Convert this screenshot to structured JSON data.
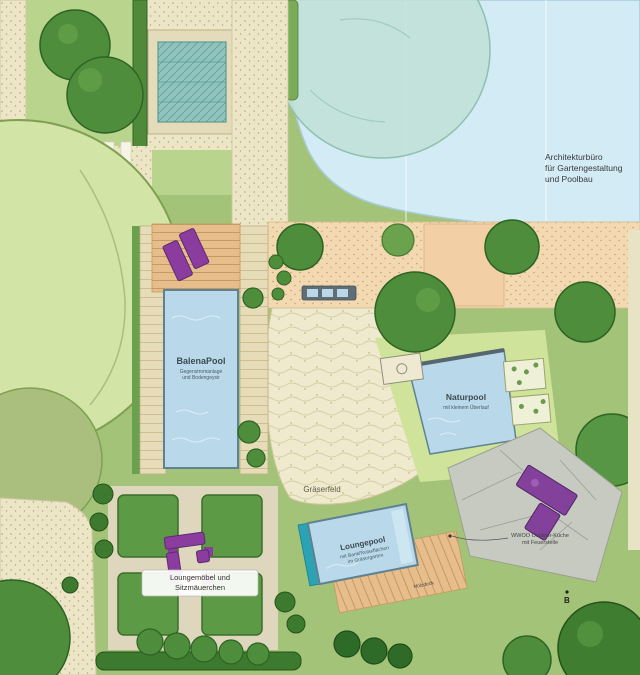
{
  "palette": {
    "lawn": "#a3c478",
    "lawn_light": "#cfe49a",
    "pond_water": "#d2ebf4",
    "pool_water": "#b9d9ea",
    "path_cream": "#ece5c6",
    "path_tan": "#f3d9b2",
    "wood_deck": "#e6bd8b",
    "tree_dark_green": "#4e8d3b",
    "tree_light_green": "#d2e4a6",
    "teal_tree": "#bfe0d6",
    "furniture_purple": "#8a3d9e",
    "lap_teal": "#2ba3b5",
    "stone_patio": "#c7cac0"
  },
  "labels": {
    "architect": {
      "line1": "Architekturbüro",
      "line2": "für Gartengestaltung",
      "line3": "und Poolbau"
    },
    "balena_pool": {
      "name": "BalenaPool",
      "sub1": "Gegenstromanlage",
      "sub2": "und Bodengeysir"
    },
    "natur_pool": {
      "name": "Naturpool",
      "sub": "mit kleinem Überlauf"
    },
    "graeserfeld": {
      "name": "Gräserfeld"
    },
    "lounge_pool": {
      "name": "Loungepool",
      "sub1": "mit Bank/Relaxflächen",
      "sub2": "im Gräsergarten"
    },
    "lounge_furniture": {
      "line1": "Loungemöbel und",
      "line2": "Sitzmäuerchen"
    },
    "outdoor_kitchen": {
      "line1": "WWOO Outdoor-Küche",
      "line2": "mit Feuerstelle"
    },
    "holzdeck": {
      "name": "Holzdeck"
    },
    "marker_b": {
      "name": "B"
    }
  }
}
